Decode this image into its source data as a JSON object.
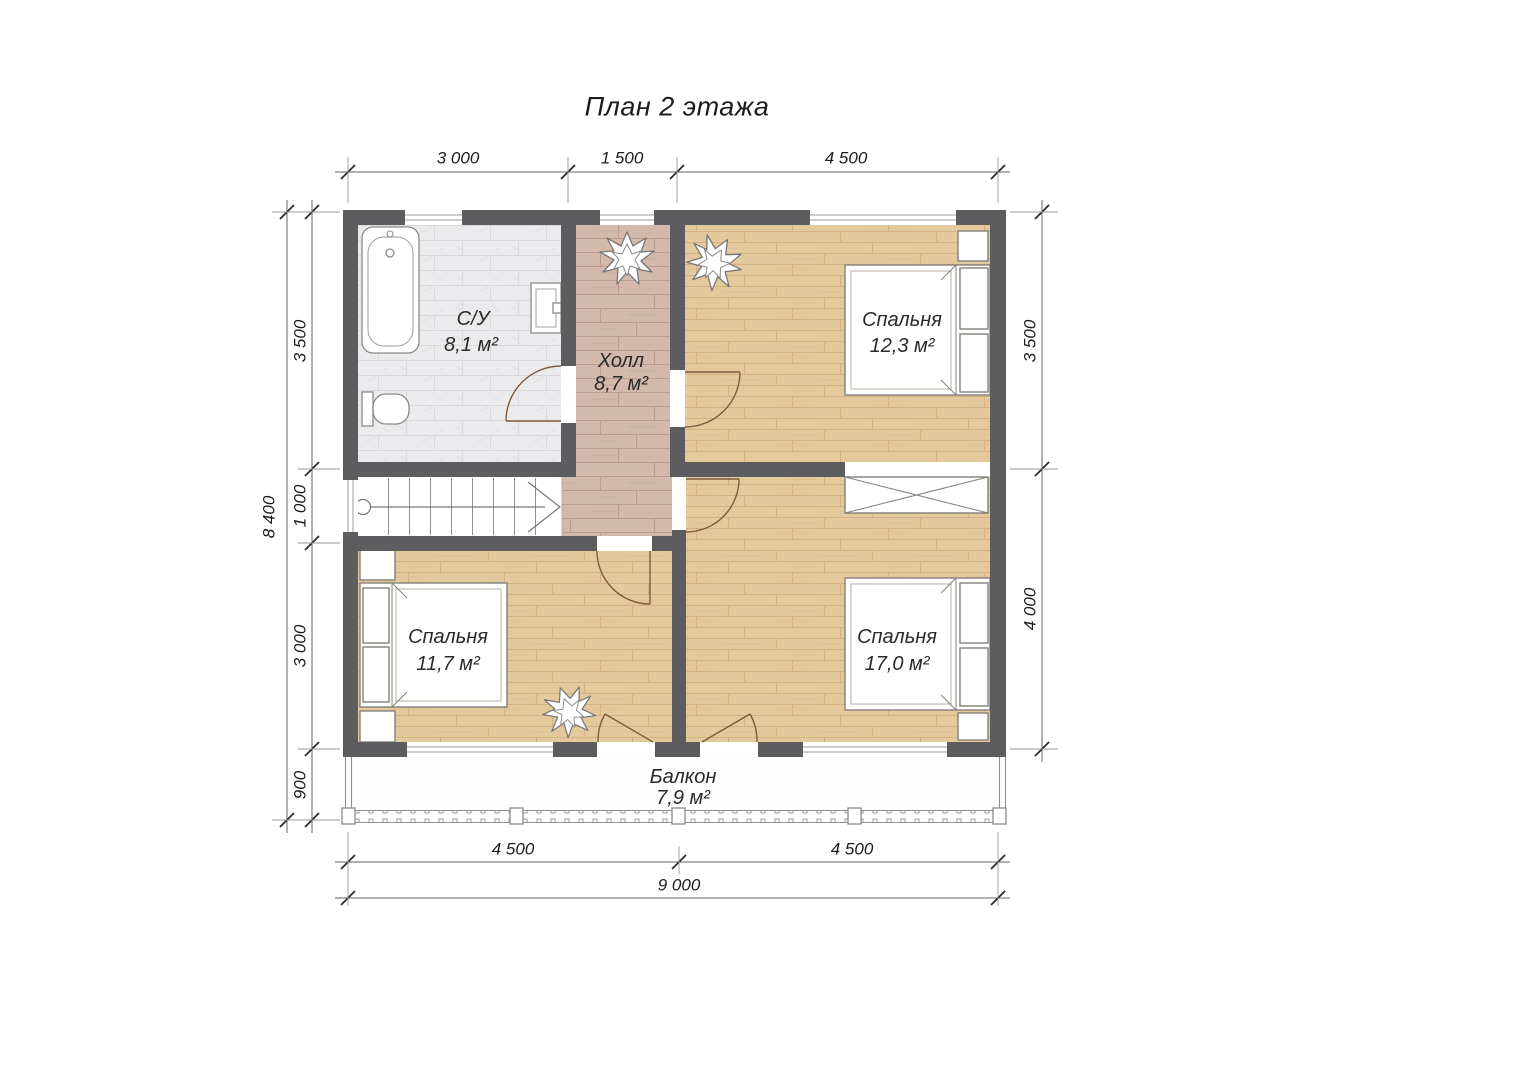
{
  "title": "План 2 этажа",
  "rooms": {
    "bathroom": {
      "name": "С/У",
      "area": "8,1 м²"
    },
    "hall": {
      "name": "Холл",
      "area": "8,7 м²"
    },
    "bedroom_top_right": {
      "name": "Спальня",
      "area": "12,3 м²"
    },
    "bedroom_bottom_left": {
      "name": "Спальня",
      "area": "11,7 м²"
    },
    "bedroom_bottom_right": {
      "name": "Спальня",
      "area": "17,0 м²"
    },
    "balcony": {
      "name": "Балкон",
      "area": "7,9 м²"
    }
  },
  "dimensions": {
    "top": {
      "seg1": "3 000",
      "seg2": "1 500",
      "seg3": "4 500"
    },
    "left": {
      "overall": "8 400",
      "seg1": "3 500",
      "seg2": "1 000",
      "seg3": "3 000",
      "seg4": "900"
    },
    "right": {
      "seg1": "3 500",
      "seg2": "4 000"
    },
    "bottom": {
      "seg1": "4 500",
      "seg2": "4 500",
      "overall": "9 000"
    }
  },
  "colors": {
    "wall": "#5d5d5f",
    "bathroom_floor": "#ebebed",
    "hall_floor": "#d2b9ab",
    "bedroom_floor": "#e4c99d",
    "door_arc": "#7d5b3d",
    "dimension_text": "#1c1c1c"
  }
}
